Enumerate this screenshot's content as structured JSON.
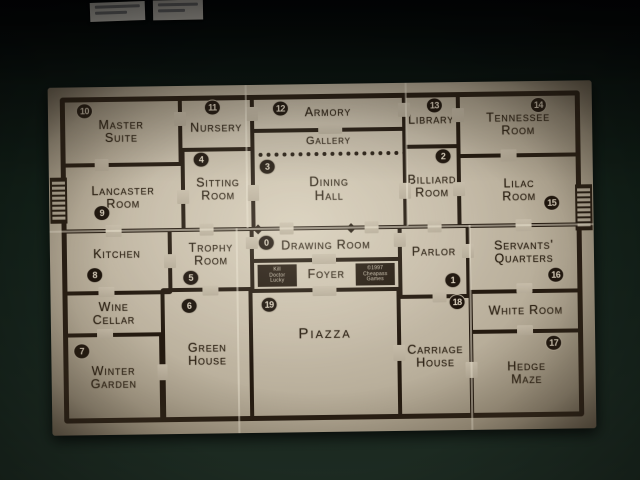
{
  "board": {
    "game": "Kill Doctor Lucky board",
    "rooms": [
      {
        "id": "master-suite",
        "name": "Master Suite",
        "number": "10"
      },
      {
        "id": "nursery",
        "name": "Nursery",
        "number": "11"
      },
      {
        "id": "armory",
        "name": "Armory",
        "number": "12"
      },
      {
        "id": "gallery",
        "name": "Gallery",
        "number": ""
      },
      {
        "id": "library",
        "name": "Library",
        "number": "13"
      },
      {
        "id": "tennessee-room",
        "name": "Tennessee Room",
        "number": "14"
      },
      {
        "id": "lancaster-room",
        "name": "Lancaster Room",
        "number": "9"
      },
      {
        "id": "sitting-room",
        "name": "Sitting Room",
        "number": "4"
      },
      {
        "id": "dining-hall",
        "name": "Dining Hall",
        "number": "3"
      },
      {
        "id": "billiard-room",
        "name": "Billiard Room",
        "number": "2"
      },
      {
        "id": "lilac-room",
        "name": "Lilac Room",
        "number": "15"
      },
      {
        "id": "kitchen",
        "name": "Kitchen",
        "number": "8"
      },
      {
        "id": "trophy-room",
        "name": "Trophy Room",
        "number": "5"
      },
      {
        "id": "drawing-room",
        "name": "Drawing Room",
        "number": "0"
      },
      {
        "id": "foyer",
        "name": "Foyer",
        "number": ""
      },
      {
        "id": "parlor",
        "name": "Parlor",
        "number": "1"
      },
      {
        "id": "servants-quarters",
        "name": "Servants' Quarters",
        "number": "16"
      },
      {
        "id": "wine-cellar",
        "name": "Wine Cellar",
        "number": ""
      },
      {
        "id": "white-room",
        "name": "White Room",
        "number": ""
      },
      {
        "id": "winter-garden",
        "name": "Winter Garden",
        "number": "7"
      },
      {
        "id": "green-house",
        "name": "Green House",
        "number": "6"
      },
      {
        "id": "piazza",
        "name": "Piazza",
        "number": "19"
      },
      {
        "id": "carriage-house",
        "name": "Carriage House",
        "number": "18"
      },
      {
        "id": "hedge-maze",
        "name": "Hedge Maze",
        "number": "17"
      }
    ],
    "title_block": [
      "Kill",
      "Doctor",
      "Lucky"
    ],
    "credit_block": [
      "©1997",
      "Cheapass",
      "Games"
    ]
  },
  "colors": {
    "table_felt": "#15231b",
    "board_face": "#c7bdaa",
    "wall_ink": "#241a10",
    "badge_fill": "#1d140c",
    "badge_text": "#ddd3c0",
    "seam": "#e8e0ce",
    "card_white": "#e8e4da"
  }
}
